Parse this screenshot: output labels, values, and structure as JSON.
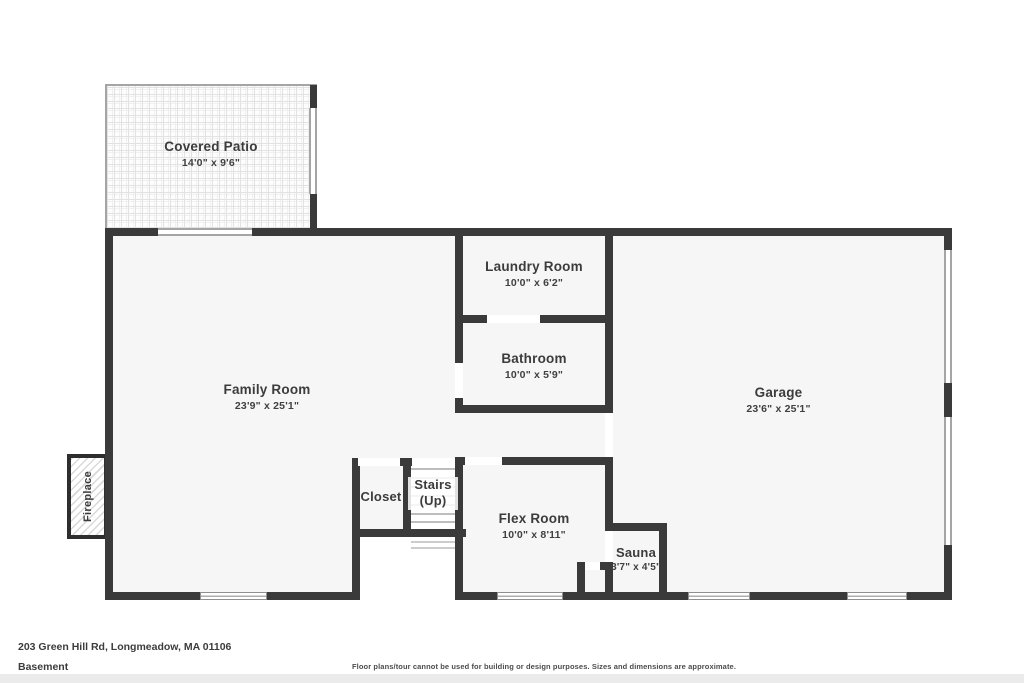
{
  "floor_plan": {
    "address": "203 Green Hill Rd, Longmeadow, MA 01106",
    "floor_label": "Basement",
    "disclaimer": "Floor plans/tour cannot be used for building or design purposes. Sizes and dimensions are approximate."
  },
  "rooms": {
    "covered_patio": {
      "name": "Covered Patio",
      "dims": "14'0\" x 9'6\""
    },
    "laundry_room": {
      "name": "Laundry Room",
      "dims": "10'0\" x 6'2\""
    },
    "bathroom": {
      "name": "Bathroom",
      "dims": "10'0\" x 5'9\""
    },
    "family_room": {
      "name": "Family Room",
      "dims": "23'9\" x 25'1\""
    },
    "garage": {
      "name": "Garage",
      "dims": "23'6\" x 25'1\""
    },
    "closet": {
      "name": "Closet"
    },
    "stairs": {
      "name": "Stairs",
      "sub": "(Up)"
    },
    "flex_room": {
      "name": "Flex Room",
      "dims": "10'0\" x 8'11\""
    },
    "sauna": {
      "name": "Sauna",
      "dims": "3'7\" x 4'5\""
    },
    "fireplace": {
      "name": "Fireplace"
    }
  },
  "colors": {
    "wall": "#3a3a3a",
    "room_fill": "#f6f6f6",
    "label_text": "#3c3c3c",
    "window_frame": "#a5a5a5"
  }
}
